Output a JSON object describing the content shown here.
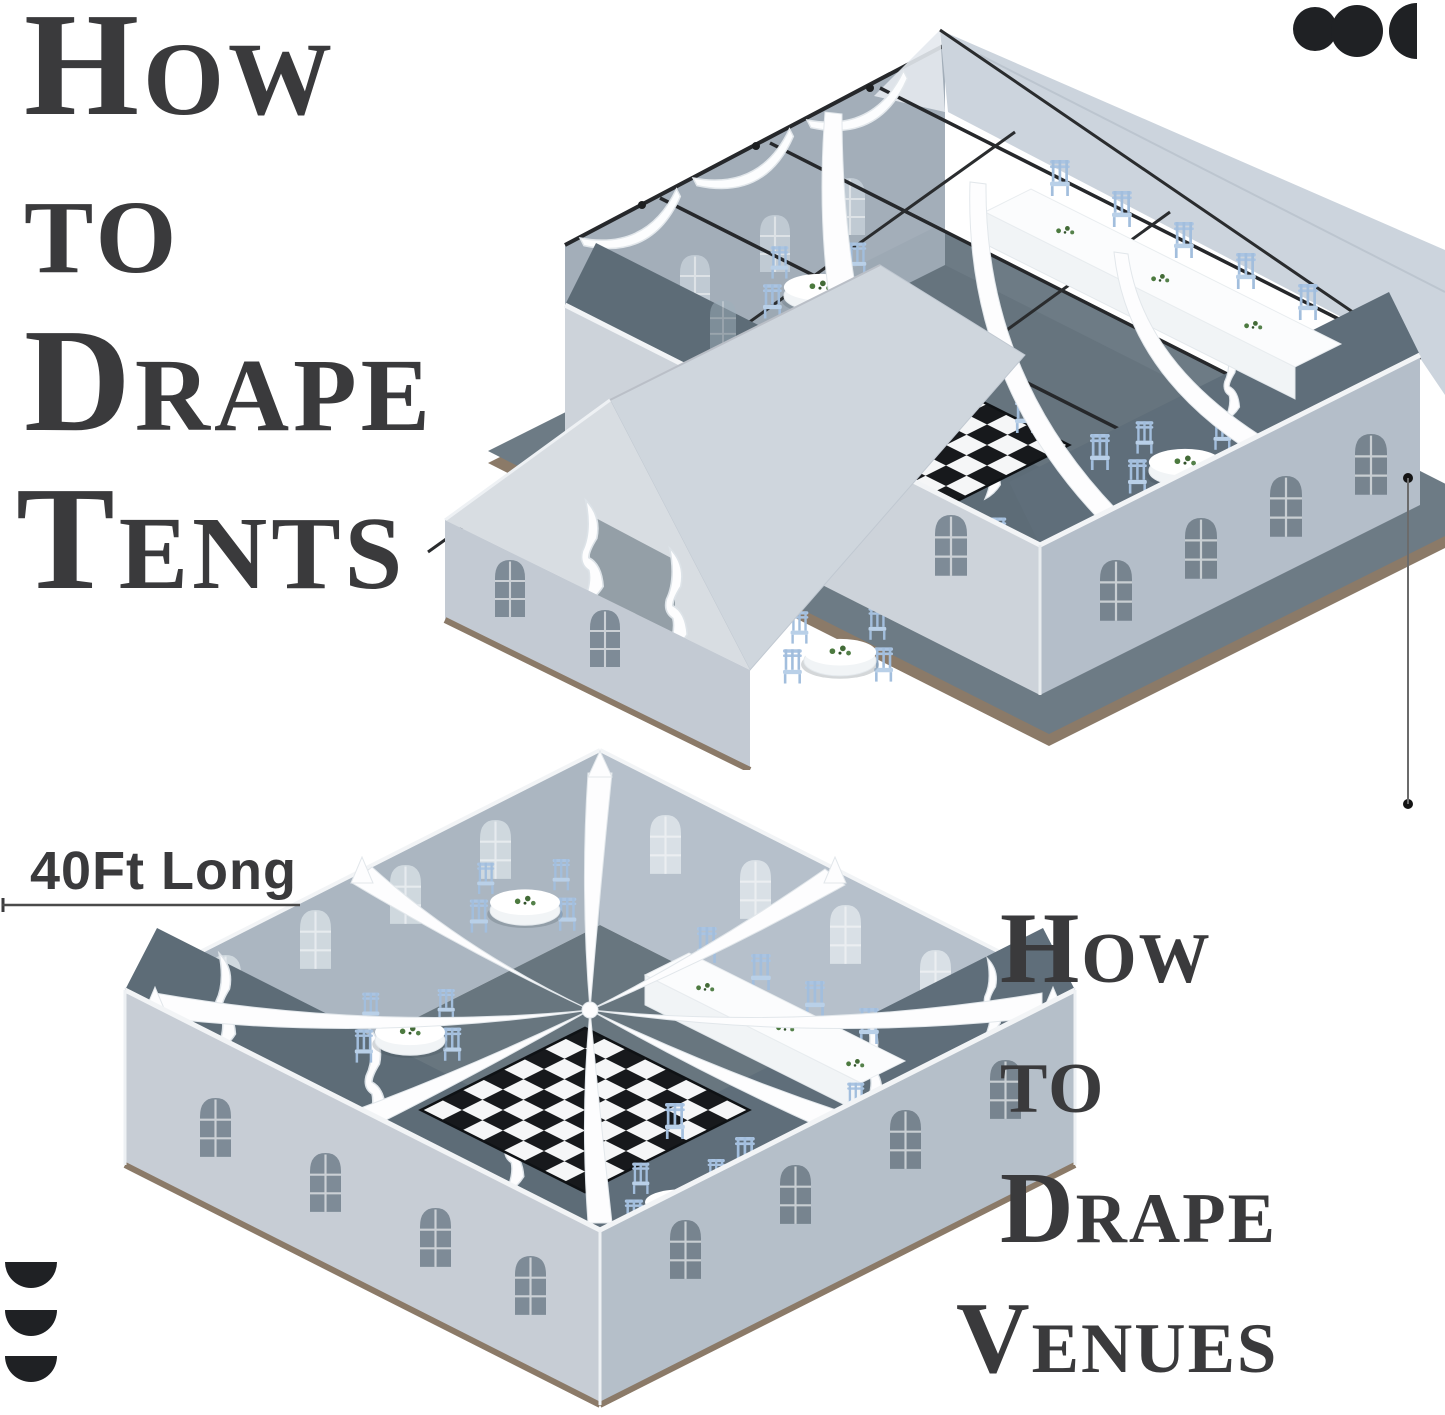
{
  "page": {
    "width": 1445,
    "height": 1415,
    "background": "#ffffff"
  },
  "titles": {
    "left": {
      "lines": [
        "How",
        "to",
        "Drape",
        "Tents"
      ],
      "color": "#3a3a3c"
    },
    "right": {
      "lines": [
        "How",
        "to",
        "Drape",
        "Venues"
      ],
      "color": "#3a3a3c"
    }
  },
  "dimension_label": {
    "text": "40Ft Long"
  },
  "brand_marks": {
    "top_right": {
      "glyphs": [
        "circle",
        "circle",
        "half-disc-flat-right"
      ],
      "color": "#1f2124"
    },
    "bottom_left": {
      "glyphs": [
        "half-disc-flat-top",
        "half-disc-flat-top",
        "half-disc-flat-top"
      ],
      "color": "#1f2124"
    }
  },
  "tent_scene": {
    "subject": "draped frame tent interior, isometric cutaway",
    "round_tables": 5,
    "head_tables": 1,
    "ceiling_drapes": 3,
    "eave_swags": 3,
    "dance_floor": "black and white checkerboard"
  },
  "venue_scene": {
    "subject": "open-top venue with eight drapes radiating from center point",
    "round_tables": 6,
    "head_tables": 1,
    "radial_drapes": 8,
    "dance_floor": "black and white checkerboard"
  },
  "palette": {
    "title_text": "#3a3a3c",
    "logo": "#1f2124",
    "wall_light": "#cdd3da",
    "wall_medium": "#b4bec9",
    "wall_far": "#9fabb6",
    "interior_dark": "#5d6c77",
    "floor": "#67757f",
    "platform": "#6d7b85",
    "platform_edge": "#8b7a68",
    "window_dark": "#7e8b97",
    "window_light": "#d3dce2",
    "chair_blue": "#aac4e2",
    "drape_white": "#fdfdfe",
    "checker_dark": "#17191c",
    "checker_light": "#f5f6f7",
    "greenery": "#4c7a3f"
  }
}
